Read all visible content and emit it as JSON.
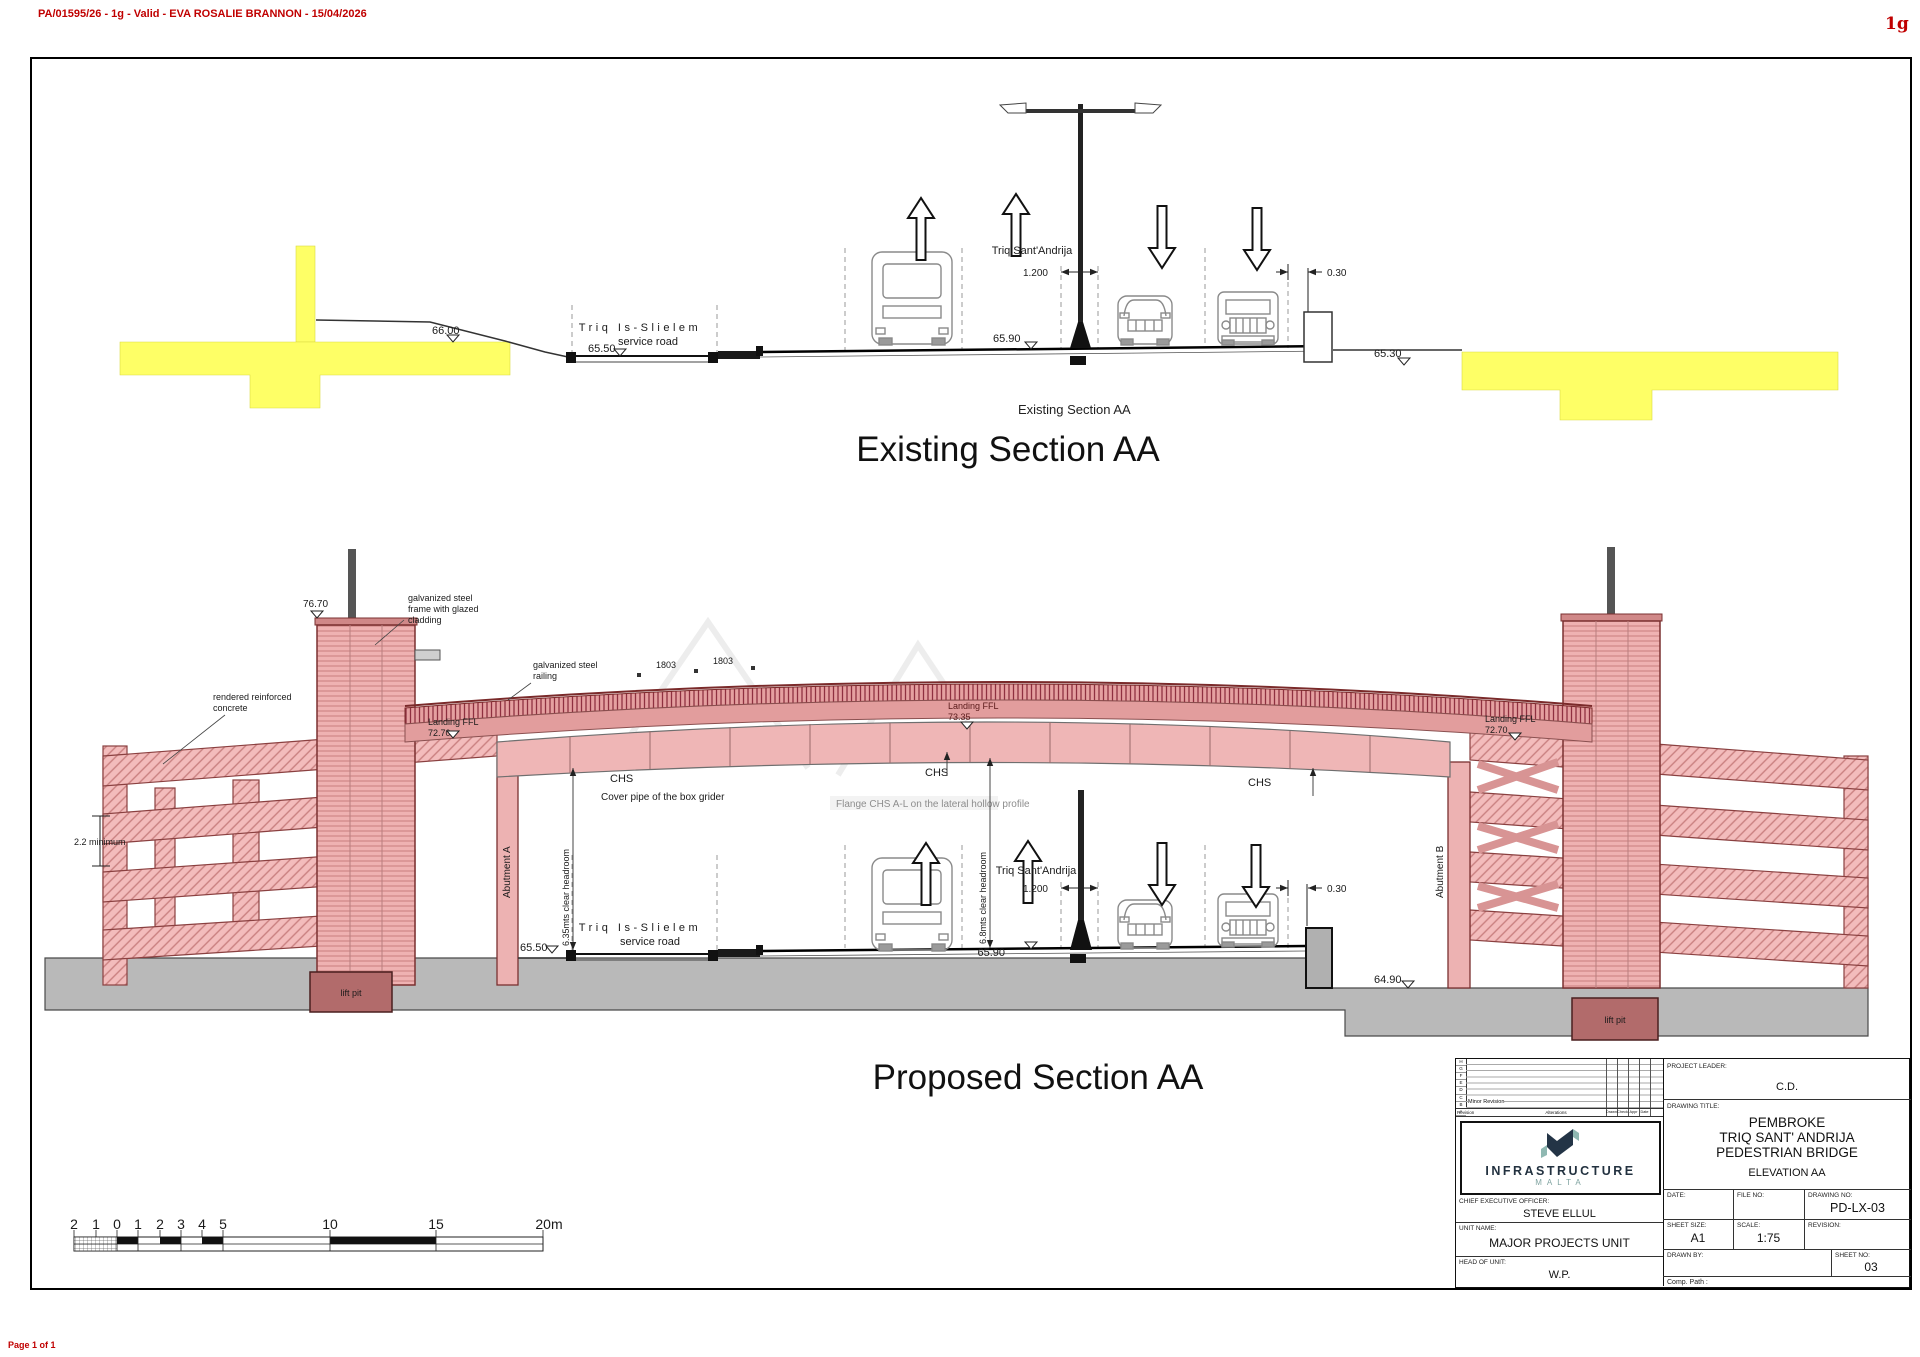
{
  "page": {
    "header_note": "PA/01595/26 - 1g - Valid - EVA ROSALIE BRANNON - 15/04/2026",
    "rev_tag": "1g",
    "footer_note": "Page 1 of 1"
  },
  "existing": {
    "caption_small": "Existing Section AA",
    "title": "Existing Section AA",
    "labels": {
      "street": "Triq Is-Slielem",
      "street_sub": "service road",
      "road_main": "Triq Sant'Andrija",
      "lvl_6600": "66.00",
      "lvl_6550": "65.50",
      "lvl_6590": "65.90",
      "lvl_6530": "65.30",
      "dim_1200": "1.200",
      "dim_030": "0.30"
    }
  },
  "proposed": {
    "title": "Proposed Section AA",
    "labels": {
      "lvl_7670": "76.70",
      "clad1": "galvanized steel",
      "clad2": "frame with glazed",
      "clad3": "cladding",
      "rail1": "galvanized steel",
      "rail2": "railing",
      "conc1": "rendered reinforced",
      "conc2": "concrete",
      "dim_min": "2.2 minimum",
      "landing": "Landing FFL",
      "land_l": "72.70",
      "land_m": "73.35",
      "land_r": "72.70",
      "dim_1803": "1803",
      "chs": "CHS",
      "cover_pipe": "Cover pipe of the box grider",
      "flange": "Flange CHS A-L on the lateral hollow profile",
      "abutment_a": "Abutment A",
      "abutment_b": "Abutment B",
      "headroom_left": "6.35mts clear headroom",
      "headroom_right": "6.8mts clear headroom",
      "street": "Triq Is-Slielem",
      "street_sub": "service road",
      "road_main": "Triq Sant'Andrija",
      "dim_1200": "1.200",
      "dim_030": "0.30",
      "lvl_6550": "65.50",
      "lvl_6590": "65.90",
      "lvl_6490": "64.90",
      "lift_pit": "lift pit"
    }
  },
  "scalebar": {
    "ticks": [
      "2",
      "1",
      "0",
      "1",
      "2",
      "3",
      "4",
      "5",
      "10",
      "15",
      "20m"
    ]
  },
  "titleblock": {
    "revision_table": {
      "rows": [
        "H",
        "G",
        "F",
        "E",
        "D",
        "C",
        "B",
        "A"
      ],
      "minor_revision": "Minor Revision",
      "col_revision": "Revision",
      "col_alterations": "Alterations",
      "col_drawn": "Drawn",
      "col_check": "Check",
      "col_appr": "Appr",
      "col_date": "Date"
    },
    "logo": {
      "line1": "INFRASTRUCTURE",
      "line2": "MALTA"
    },
    "project_leader_label": "PROJECT LEADER:",
    "project_leader": "C.D.",
    "drawing_title_label": "DRAWING TITLE:",
    "drawing_title": [
      "PEMBROKE",
      "TRIQ SANT' ANDRIJA",
      "PEDESTRIAN BRIDGE"
    ],
    "drawing_subtitle": "ELEVATION AA",
    "ceo_label": "CHIEF EXECUTIVE OFFICER:",
    "ceo": "STEVE ELLUL",
    "unit_label": "UNIT NAME:",
    "unit": "MAJOR PROJECTS UNIT",
    "head_label": "HEAD OF UNIT:",
    "head": "W.P.",
    "date_label": "DATE:",
    "file_no_label": "FILE NO:",
    "drawing_no_label": "DRAWING NO:",
    "drawing_no": "PD-LX-03",
    "sheet_size_label": "SHEET SIZE:",
    "sheet_size": "A1",
    "scale_label": "SCALE:",
    "scale": "1:75",
    "revision_label": "REVISION:",
    "drawn_by_label": "DRAWN BY:",
    "sheet_no_label": "SHEET NO:",
    "sheet_no": "03",
    "comp_path_label": "Comp. Path :"
  }
}
